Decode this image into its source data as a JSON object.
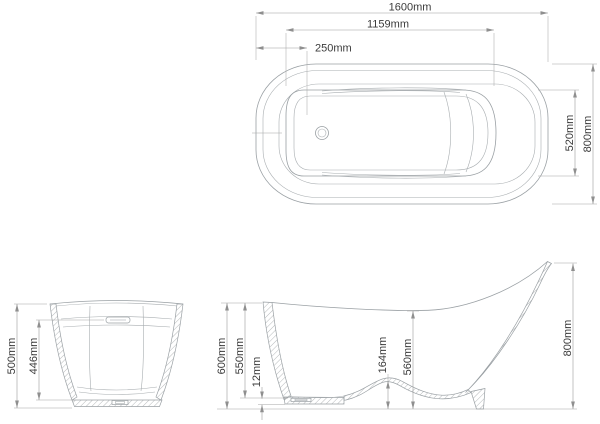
{
  "drawing": {
    "background_color": "#ffffff",
    "geometry_line_color": "#9aa0a4",
    "dimension_line_color": "#9b9b9b",
    "text_color": "#3b3b3b"
  },
  "views": {
    "top_view": {
      "dims": {
        "overall_length": "1600mm",
        "opening_length": "1159mm",
        "drain_offset": "250mm",
        "opening_width": "520mm",
        "overall_width": "800mm"
      }
    },
    "end_view": {
      "dims": {
        "overall_height": "500mm",
        "inner_height": "446mm"
      }
    },
    "side_view": {
      "dims": {
        "rim_height_front": "600mm",
        "inner_depth_front": "550mm",
        "base_thickness": "12mm",
        "sump_step_height": "164mm",
        "inner_depth_center": "560mm",
        "backrest_height": "800mm"
      }
    }
  }
}
